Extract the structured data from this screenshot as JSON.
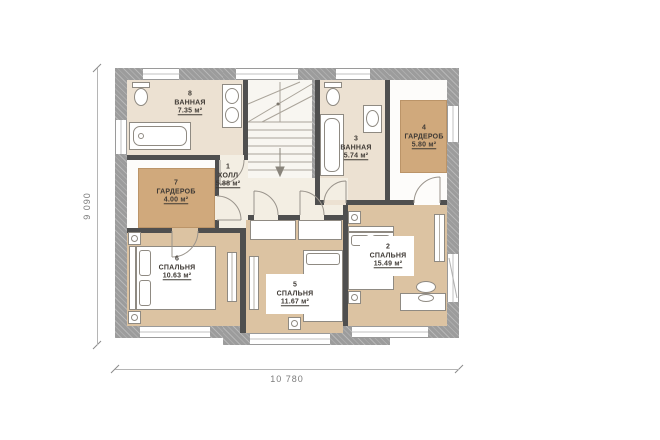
{
  "image_type": "floor-plan-drawing",
  "floor_plan": {
    "rooms": [
      {
        "number": "1",
        "name": "ХОЛЛ",
        "area": "5.88 м²"
      },
      {
        "number": "2",
        "name": "СПАЛЬНЯ",
        "area": "15.49 м²"
      },
      {
        "number": "3",
        "name": "ВАННАЯ",
        "area": "5.74 м²"
      },
      {
        "number": "4",
        "name": "ГАРДЕРОБ",
        "area": "5.80 м²"
      },
      {
        "number": "5",
        "name": "СПАЛЬНЯ",
        "area": "11.67 м²"
      },
      {
        "number": "6",
        "name": "СПАЛЬНЯ",
        "area": "10.63 м²"
      },
      {
        "number": "7",
        "name": "ГАРДЕРОБ",
        "area": "4.00 м²"
      },
      {
        "number": "8",
        "name": "ВАННАЯ",
        "area": "7.35 м²"
      }
    ],
    "dimensions": {
      "overall_width": "10 780",
      "overall_height": "9 090"
    },
    "colors": {
      "bedroom_floor": "#dcc3a2",
      "bathroom_floor": "#ece1d2",
      "hall_floor": "#f3eee3",
      "stairs_floor": "#f8f6f1",
      "wardrobe_fill": "#d0a97c",
      "exterior_wall": "#9c9c9c",
      "partition_wall": "#4f4f4f",
      "background": "#ffffff"
    },
    "icons": [
      "toilet-icon",
      "sink-icon",
      "bathtub-icon",
      "bed-icon",
      "nightstand-icon",
      "stairs-icon",
      "door-arc-icon",
      "window-icon",
      "radiator-icon",
      "desk-icon",
      "chair-icon",
      "wardrobe-icon"
    ]
  }
}
